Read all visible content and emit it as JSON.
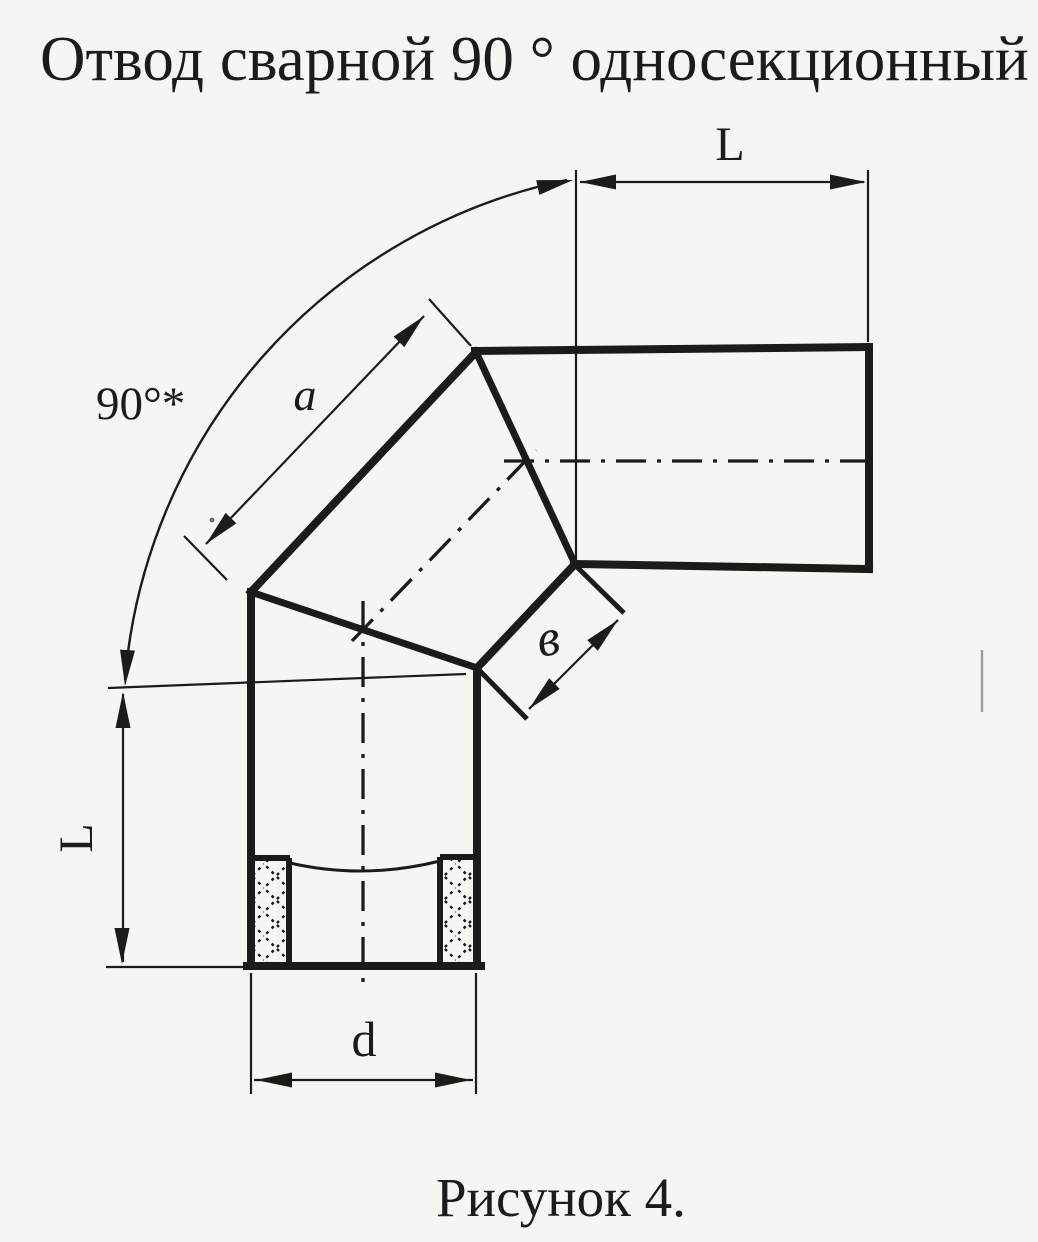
{
  "title": "Отвод сварной 90 ° односекционный",
  "caption": "Рисунок 4.",
  "labels": {
    "length_top": "L",
    "angle": "90°*",
    "section_a": "a",
    "width_b": "в",
    "length_left": "L",
    "diameter_d": "d"
  },
  "colors": {
    "ink": "#1b1b1b",
    "paper": "#f6f5f2"
  }
}
